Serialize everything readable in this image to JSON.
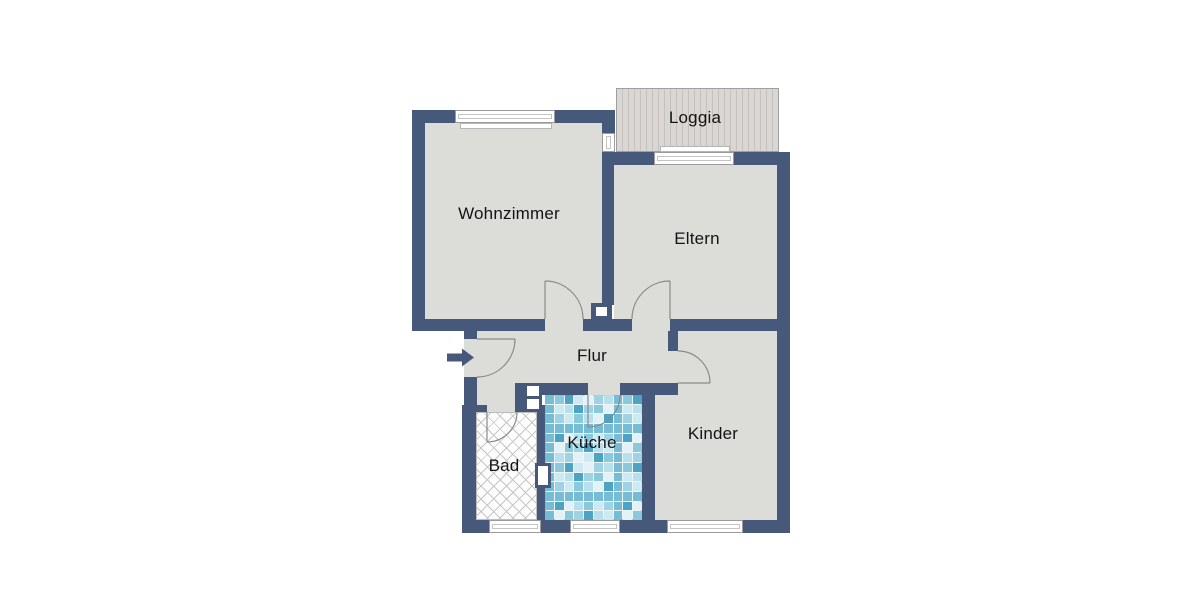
{
  "plan": {
    "type": "apartment-floor-plan",
    "entrance": {
      "arrow_direction": "right",
      "side": "left-wall-of-hallway"
    }
  },
  "rooms": {
    "wohnzimmer": {
      "label": "Wohnzimmer",
      "floor_pattern": "plain-gray"
    },
    "loggia": {
      "label": "Loggia",
      "floor_pattern": "wood-decking-stripes"
    },
    "eltern": {
      "label": "Eltern",
      "floor_pattern": "plain-gray"
    },
    "flur": {
      "label": "Flur",
      "floor_pattern": "plain-gray"
    },
    "bad": {
      "label": "Bad",
      "floor_pattern": "crosshatch-tiles"
    },
    "kueche": {
      "label": "Küche",
      "floor_pattern": "blue-mosaic-tiles"
    },
    "kinder": {
      "label": "Kinder",
      "floor_pattern": "plain-gray"
    }
  },
  "colors": {
    "wall": "#46597b",
    "floor": "#dcddd9",
    "loggia_deck_light": "#dad6d3",
    "loggia_deck_dark": "#c5c1bd",
    "door_arc": "#8a8a8a",
    "window_frame": "#9b9b9b",
    "hatch_line": "#c6c6c6",
    "entrance_arrow": "#46597b",
    "tile_palette": [
      "#cde9f2",
      "#9fd3e3",
      "#76bcd4",
      "#4ea3c2",
      "#e3f2f7",
      "#b7e0ec",
      "#8ac8db"
    ]
  }
}
